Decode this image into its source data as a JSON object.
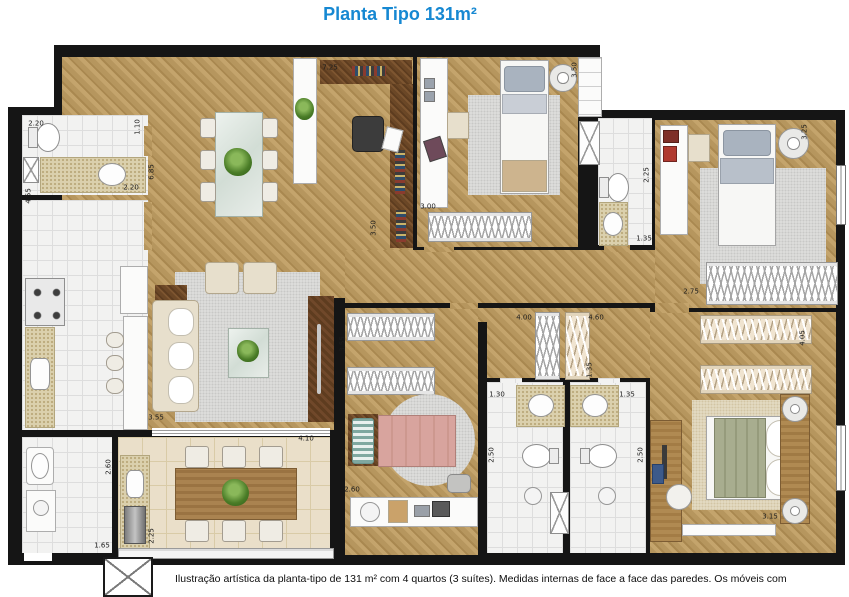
{
  "title": "Planta Tipo 131m²",
  "caption": "Ilustração artística da planta-tipo de 131 m² com 4 quartos (3 suítes). Medidas internas de face a face das paredes. Os móveis com",
  "colors": {
    "title_blue": "#1688d2",
    "wall_black": "#151515",
    "wood_floor": "#b6965e",
    "dark_wood": "#6b4726",
    "tile_white": "#f2f2f1",
    "tile_beige": "#eadfc9",
    "counter_speckle": "#dbd0ad",
    "rug_gray": "#e0e0de",
    "bed_pink": "#d8a49e",
    "bed_green": "#a8ad8f",
    "pillow_blue": "#a9b3bf"
  },
  "dimensions": [
    {
      "text": "7.25",
      "x": 330,
      "y": 68,
      "rot": false
    },
    {
      "text": "2.20",
      "x": 36,
      "y": 124,
      "rot": false
    },
    {
      "text": "1.10",
      "x": 138,
      "y": 127,
      "rot": true
    },
    {
      "text": "4.55",
      "x": 29,
      "y": 196,
      "rot": true
    },
    {
      "text": "2.20",
      "x": 131,
      "y": 188,
      "rot": false
    },
    {
      "text": "6.85",
      "x": 152,
      "y": 172,
      "rot": true
    },
    {
      "text": "3.50",
      "x": 575,
      "y": 70,
      "rot": true
    },
    {
      "text": "3.00",
      "x": 428,
      "y": 207,
      "rot": false
    },
    {
      "text": "3.50",
      "x": 374,
      "y": 228,
      "rot": true
    },
    {
      "text": "3.25",
      "x": 805,
      "y": 132,
      "rot": true
    },
    {
      "text": "2.25",
      "x": 647,
      "y": 175,
      "rot": true
    },
    {
      "text": "1.35",
      "x": 644,
      "y": 239,
      "rot": false
    },
    {
      "text": "2.75",
      "x": 691,
      "y": 292,
      "rot": false
    },
    {
      "text": "3.55",
      "x": 156,
      "y": 418,
      "rot": false
    },
    {
      "text": "4.10",
      "x": 306,
      "y": 439,
      "rot": false
    },
    {
      "text": "2.60",
      "x": 109,
      "y": 467,
      "rot": true
    },
    {
      "text": "1.65",
      "x": 102,
      "y": 546,
      "rot": false
    },
    {
      "text": "2.25",
      "x": 152,
      "y": 536,
      "rot": true
    },
    {
      "text": "3.55",
      "x": 343,
      "y": 344,
      "rot": true
    },
    {
      "text": "2.60",
      "x": 352,
      "y": 490,
      "rot": false
    },
    {
      "text": "4.00",
      "x": 524,
      "y": 318,
      "rot": false
    },
    {
      "text": "4.60",
      "x": 596,
      "y": 318,
      "rot": false
    },
    {
      "text": "1.35",
      "x": 590,
      "y": 370,
      "rot": true
    },
    {
      "text": "1.30",
      "x": 497,
      "y": 395,
      "rot": false
    },
    {
      "text": "1.35",
      "x": 627,
      "y": 395,
      "rot": false
    },
    {
      "text": "2.50",
      "x": 492,
      "y": 455,
      "rot": true
    },
    {
      "text": "2.50",
      "x": 641,
      "y": 455,
      "rot": true
    },
    {
      "text": "4.05",
      "x": 803,
      "y": 338,
      "rot": true
    },
    {
      "text": "3.15",
      "x": 770,
      "y": 517,
      "rot": false
    }
  ]
}
